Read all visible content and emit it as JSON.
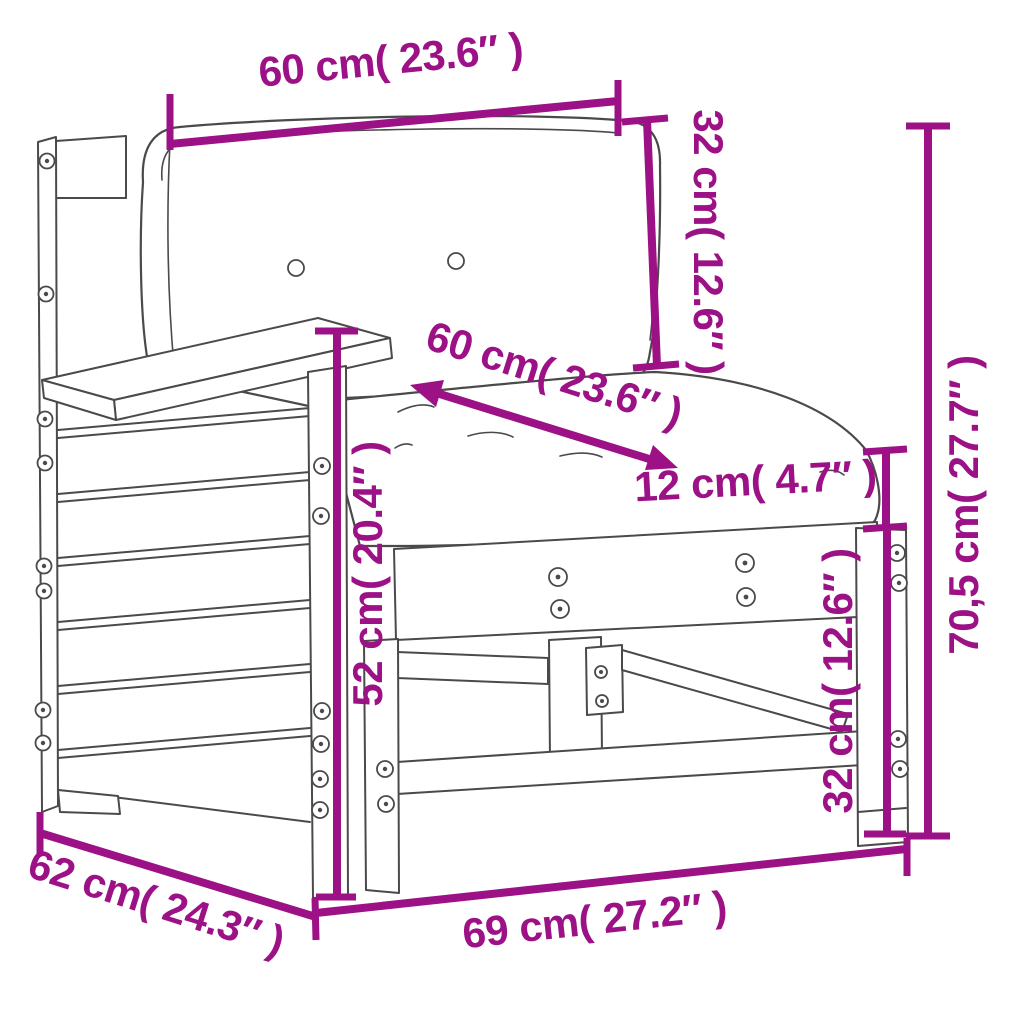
{
  "page": {
    "title": "Garden sofa section with armrest — dimension diagram"
  },
  "colors": {
    "dimension": "#9C1185",
    "outline": "#4A4A4A",
    "background": "#FFFFFF"
  },
  "dimensions": {
    "back_cushion_width": {
      "label": "60 cm( 23.6″ )",
      "cm": "60",
      "inch": "23.6"
    },
    "back_cushion_height": {
      "label": "32 cm( 12.6″ )",
      "cm": "32",
      "inch": "12.6"
    },
    "seat_cushion_depth": {
      "label": "60 cm( 23.6″ )",
      "cm": "60",
      "inch": "23.6"
    },
    "seat_cushion_thickness": {
      "label": "12 cm( 4.7″ )",
      "cm": "12",
      "inch": "4.7"
    },
    "total_height": {
      "label": "70,5 cm( 27.7″ )",
      "cm": "70,5",
      "inch": "27.7"
    },
    "armrest_height": {
      "label": "52 cm( 20.4″ )",
      "cm": "52",
      "inch": "20.4"
    },
    "seat_frame_height": {
      "label": "32 cm( 12.6″ )",
      "cm": "32",
      "inch": "12.6"
    },
    "depth": {
      "label": "62 cm( 24.3″ )",
      "cm": "62",
      "inch": "24.3"
    },
    "width": {
      "label": "69 cm( 27.2″ )",
      "cm": "69",
      "inch": "27.2"
    }
  }
}
